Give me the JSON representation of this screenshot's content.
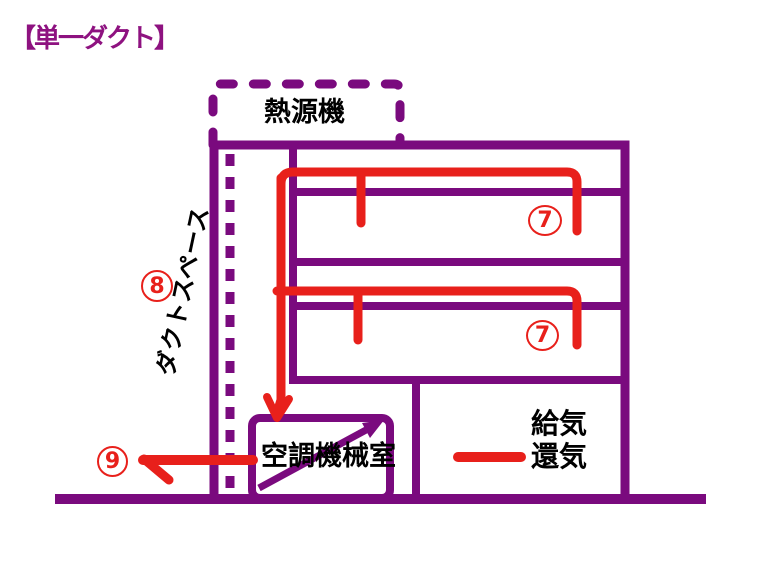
{
  "colors": {
    "purple": "#7A0A7E",
    "red": "#E8201B",
    "ink": "#000000",
    "title": "#8E1280",
    "background": "#FFFFFF"
  },
  "title": "【単一ダクト】",
  "labels": {
    "heat_source": "熱源機",
    "duct_space": "ダクトスペース",
    "machine_room": "空調機械室",
    "legend_supply": "給気",
    "legend_return": "還気"
  },
  "numbers": {
    "floor1": "7",
    "floor2": "7",
    "duct_space": "8",
    "exhaust": "9"
  }
}
